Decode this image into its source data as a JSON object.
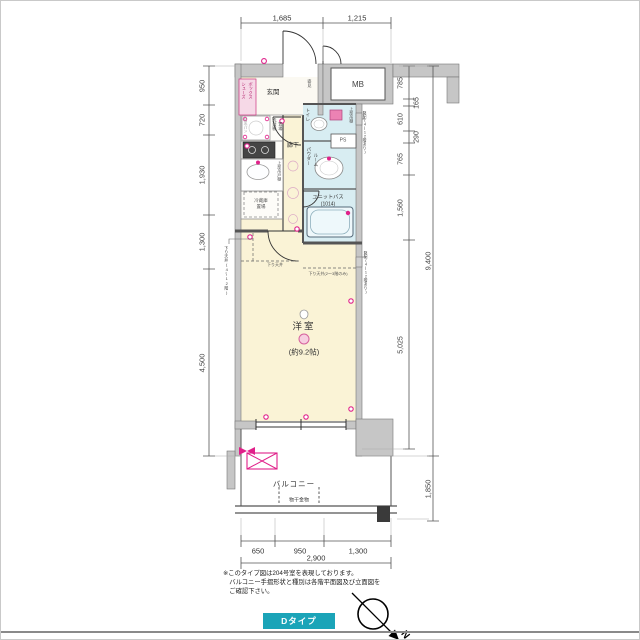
{
  "meta": {
    "type_badge": "Dタイプ",
    "compass_label": "N"
  },
  "notes": {
    "line1": "※このタイプ図は204号室を表現しております。",
    "line2": "　バルコニー手摺形状と種別は各階平面図及び立面図を",
    "line3": "　ご確認下さい。"
  },
  "rooms": {
    "genkan": "玄関",
    "mb": "MB",
    "ps": "PS",
    "shoes_l1": "シューズ",
    "shoes_l2": "ボックス",
    "mirror": "姿見",
    "toilet": "トイレ",
    "toilet_shelf": "上部吊棚",
    "powder_l1": "パウダー",
    "powder_l2": "ルーム",
    "hallway": "廊下",
    "washer_l1": "洗濯機",
    "washer_l2": "置場",
    "waterproof_pan": "防水パン",
    "kitchen_shelf": "上部吊戸棚",
    "fridge_l1": "冷蔵庫",
    "fridge_l2": "置場",
    "unit_bath_l1": "ユニットバス",
    "unit_bath_l2": "(1014)",
    "western_room": "洋室",
    "western_room_size": "(約9.2帖)",
    "balcony": "バルコニー",
    "laundry_hardware": "物干金物",
    "drop_ceiling_1": "下り天井",
    "drop_ceiling_2": "下り天井(2～3階のみ)",
    "drop_ceiling_3": "下り天井(4～12階)",
    "riser_1": "竪配(4～12階あり)",
    "riser_2": "竪配(4～12階あり)"
  },
  "dims": {
    "top": [
      "1,685",
      "1,215"
    ],
    "left": [
      "950",
      "720",
      "1,930",
      "1,300",
      "4,500"
    ],
    "right": [
      "785",
      "165",
      "610",
      "290",
      "765",
      "1,560",
      "5,025"
    ],
    "right_total": "9,400",
    "balcony_depth": "1,850",
    "bottom": [
      "650",
      "950",
      "1,300"
    ],
    "bottom_total": "2,900"
  },
  "colors": {
    "accent_teal": "#1ba4b8",
    "magenta": "#e0218a",
    "wall_gray": "#c6c6c6",
    "floor_cream": "#faf3d6",
    "wet_blue": "#d8edf2",
    "shoe_pink": "#f6d9e7"
  }
}
